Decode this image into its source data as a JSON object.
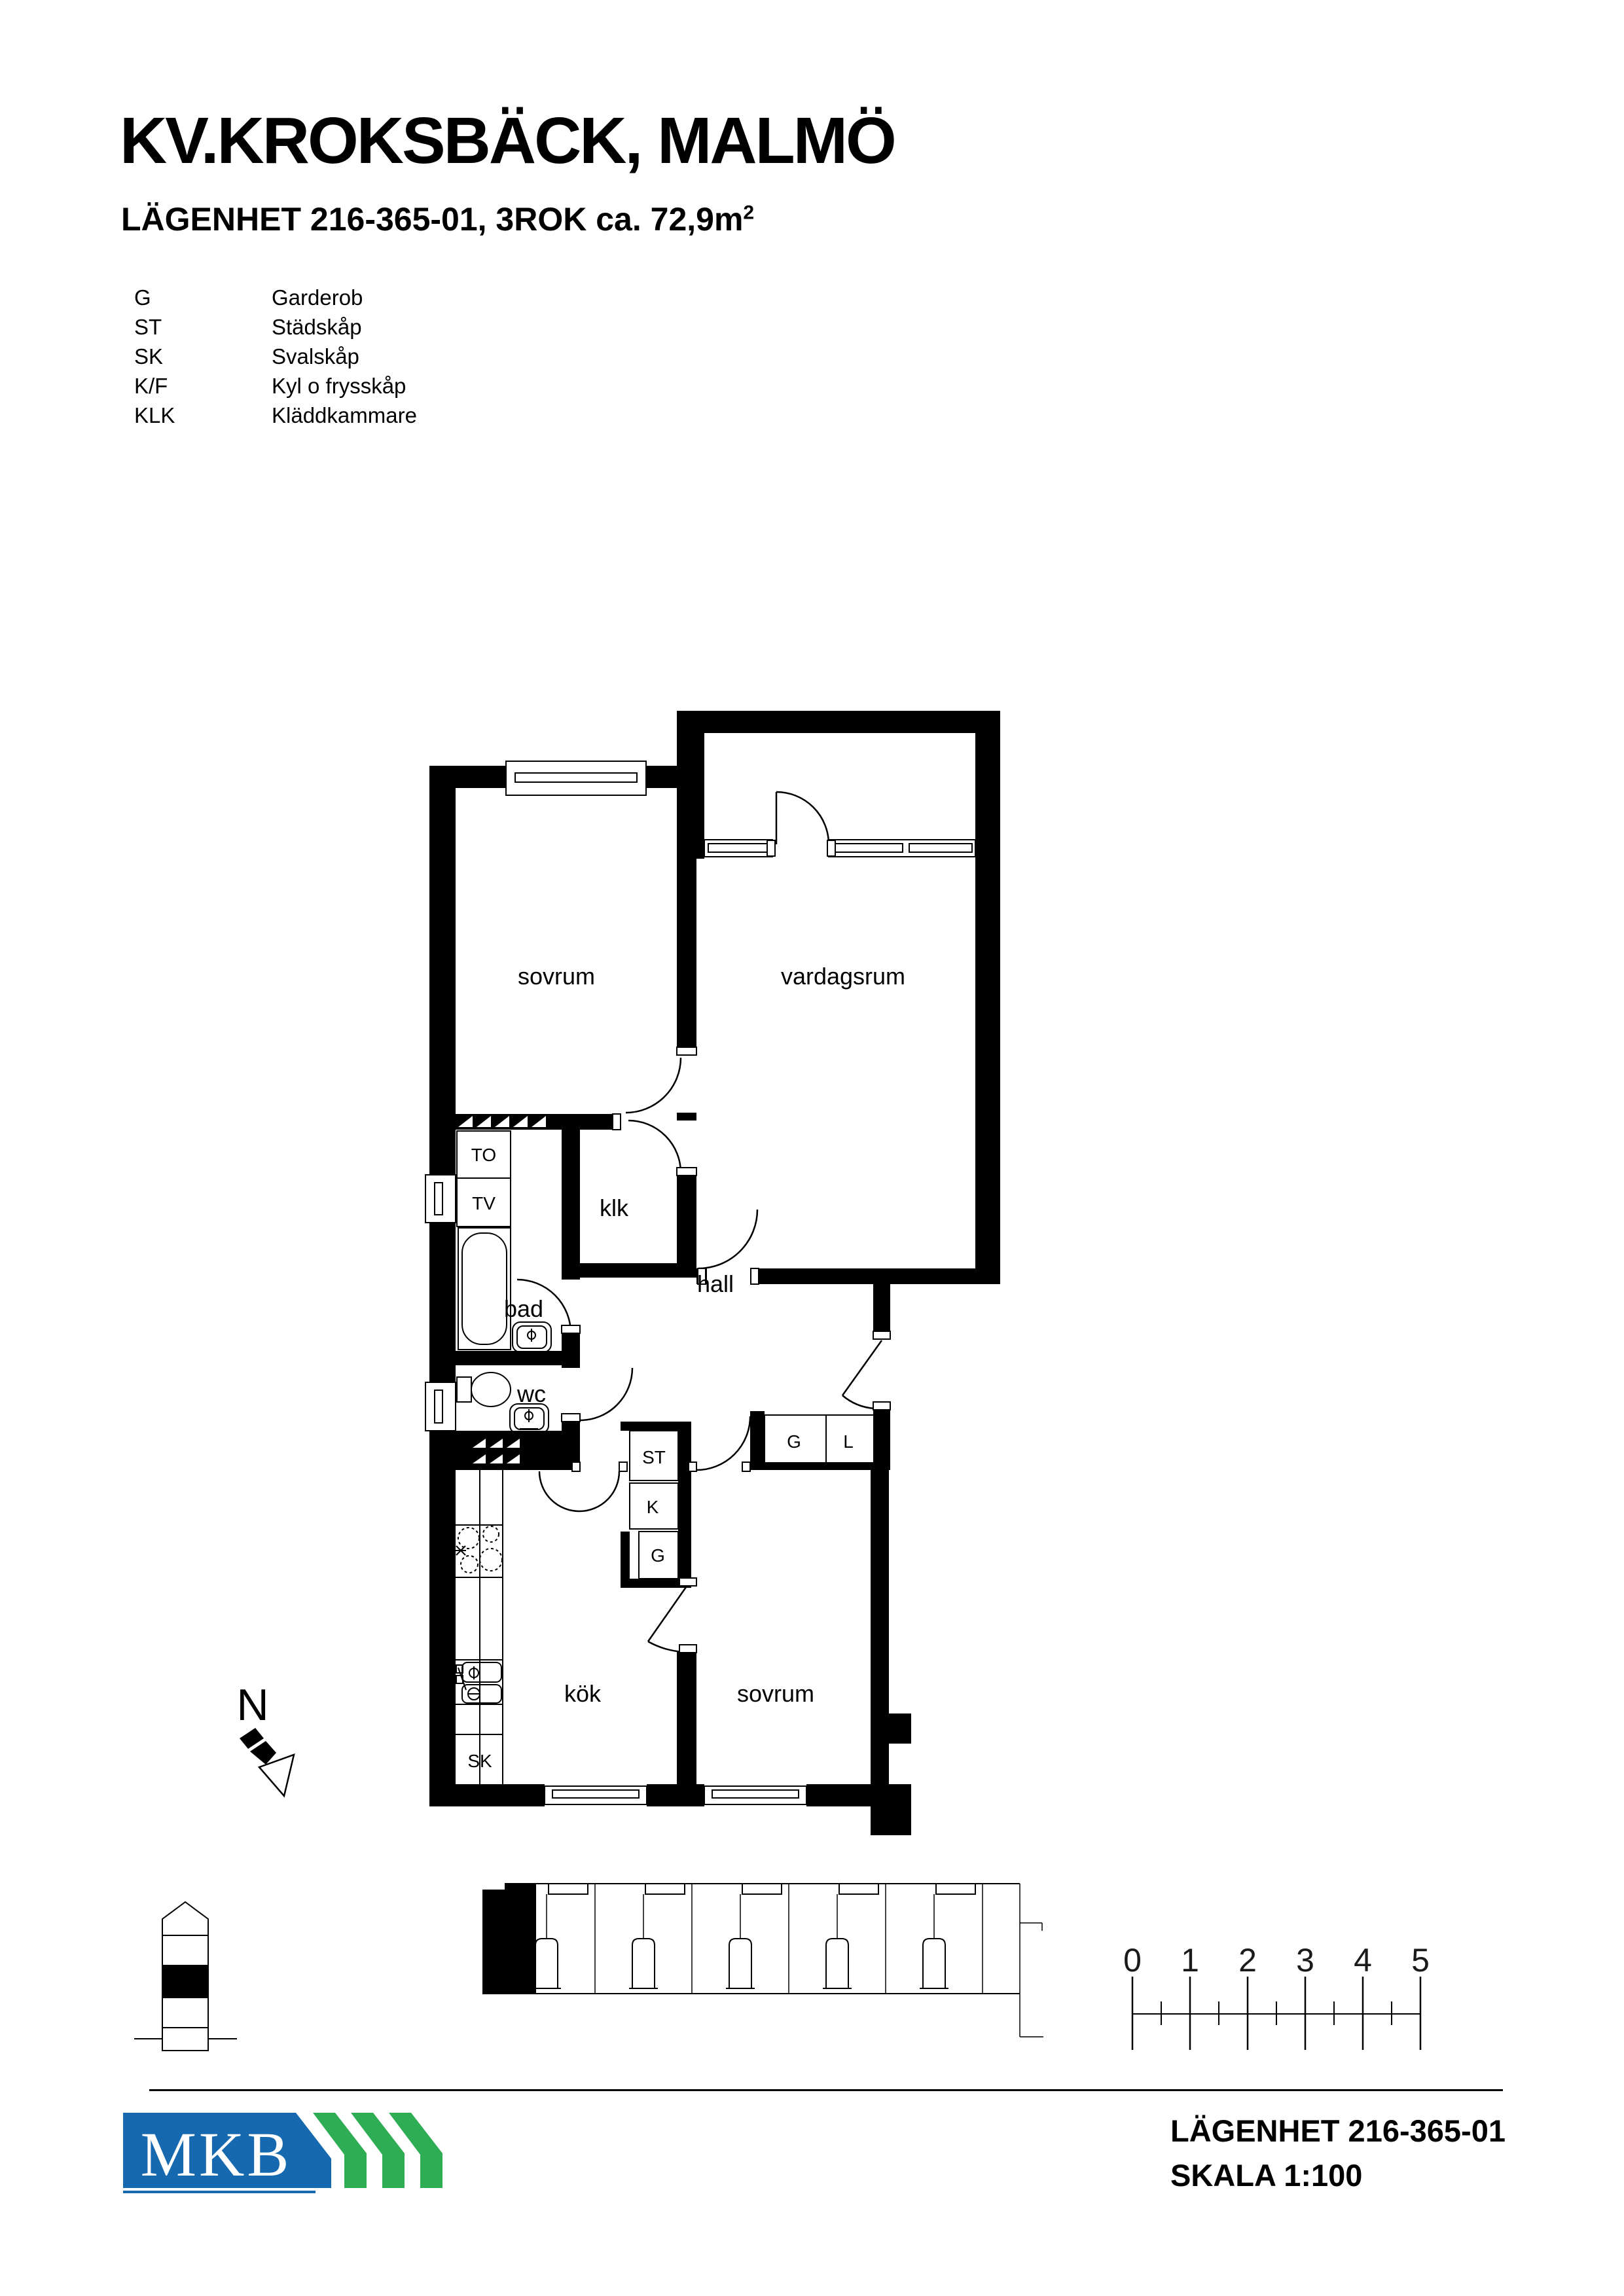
{
  "header": {
    "title": "KV.KROKSBÄCK, MALMÖ",
    "subtitle_main": "LÄGENHET 216-365-01, 3ROK ca. 72,9m",
    "subtitle_sup": "2"
  },
  "legend": {
    "items": [
      {
        "abbr": "G",
        "label": "Garderob"
      },
      {
        "abbr": "ST",
        "label": "Städskåp"
      },
      {
        "abbr": "SK",
        "label": "Svalskåp"
      },
      {
        "abbr": "K/F",
        "label": "Kyl o frysskåp"
      },
      {
        "abbr": "KLK",
        "label": "Kläddkammare"
      }
    ]
  },
  "plan": {
    "rooms": {
      "sovrum_1": "sovrum",
      "vardagsrum": "vardagsrum",
      "klk": "klk",
      "bad": "bad",
      "hall": "hall",
      "wc": "wc",
      "kok": "kök",
      "sovrum_2": "sovrum"
    },
    "cabinets": {
      "to": "TO",
      "tv": "TV",
      "st": "ST",
      "k": "K",
      "g_kitchen": "G",
      "g_closet": "G",
      "l_closet": "L",
      "sk": "SK"
    }
  },
  "compass": {
    "label": "N"
  },
  "scale_bar": {
    "ticks": [
      "0",
      "1",
      "2",
      "3",
      "4",
      "5"
    ]
  },
  "footer": {
    "apartment": "LÄGENHET 216-365-01",
    "scale": "SKALA 1:100",
    "logo_text": "MKB"
  },
  "colors": {
    "logo_blue": "#1669ae",
    "logo_green": "#2fad55",
    "ink": "#000000"
  }
}
